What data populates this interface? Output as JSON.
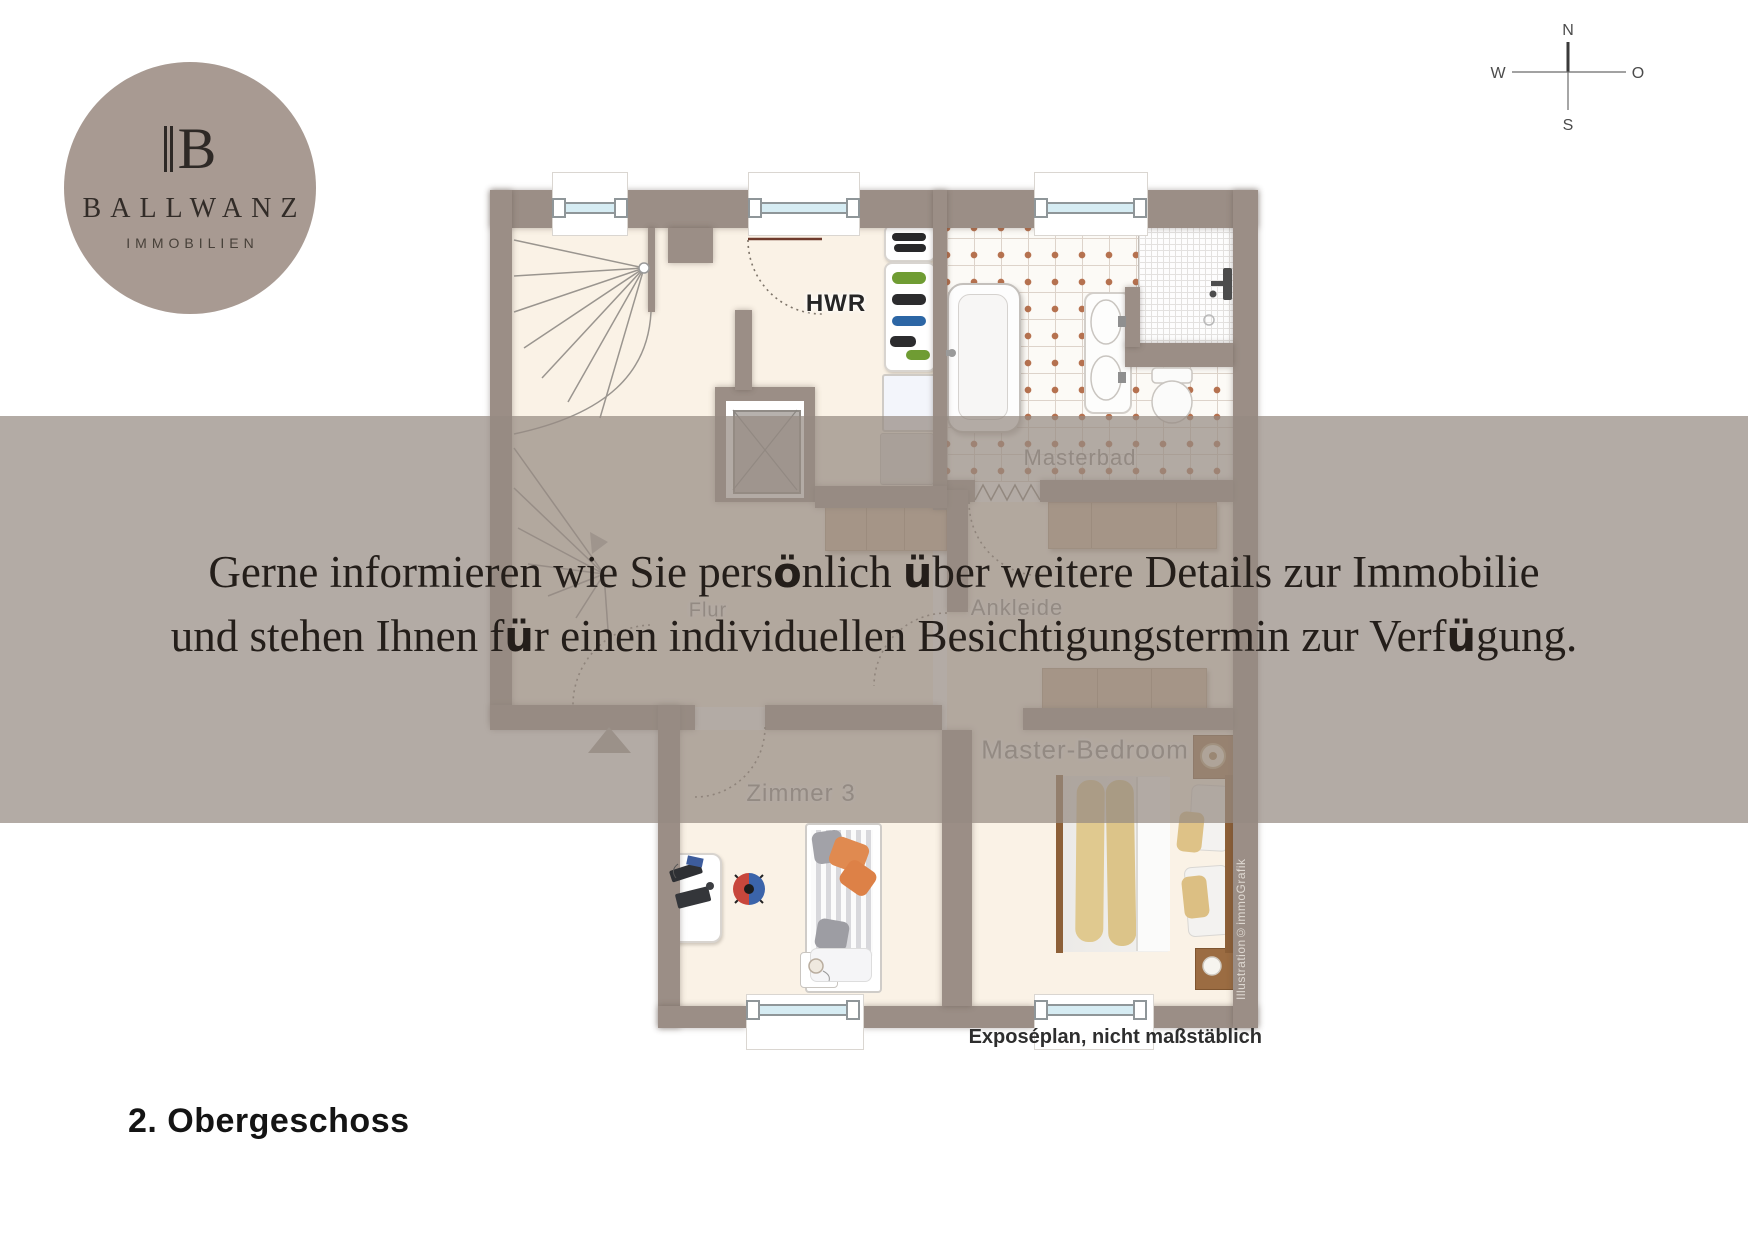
{
  "logo": {
    "monogram_letter": "B",
    "name": "BALLWANZ",
    "subtitle": "IMMOBILIEN"
  },
  "compass": {
    "north": "N",
    "west": "W",
    "east": "O",
    "south": "S"
  },
  "overlay": {
    "line1": "Gerne informieren wie Sie persönlich über weitere Details zur Immobilie",
    "line2": "und stehen Ihnen für einen individuellen Besichtigungstermin zur Verfügung."
  },
  "floorplan": {
    "room_labels": {
      "hwr": "HWR",
      "masterbad": "Masterbad",
      "flur": "Flur",
      "ankleide": "Ankleide",
      "zimmer3": "Zimmer 3",
      "master_bedroom": "Master-Bedroom"
    },
    "caption": "Exposéplan, nicht maßstäblich",
    "credit": "Illustration©immoGrafik"
  },
  "footer": {
    "title": "2. Obergeschoss"
  },
  "colors": {
    "brand_circle": "#a89a92",
    "wall": "#9b8e86",
    "floor": "#faf2e6",
    "overlay_band": "#b3aaa4",
    "tile_dot": "#b5714f",
    "wood": "#cdb195",
    "window_glass": "#d6ecf3"
  }
}
